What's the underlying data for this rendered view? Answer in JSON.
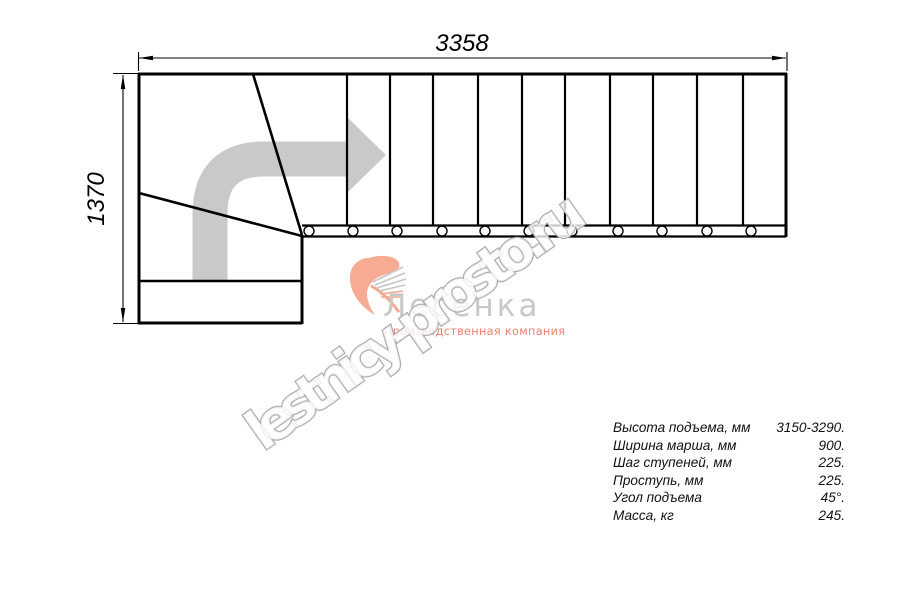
{
  "watermark": {
    "text": "lestnicy-prosto.ru"
  },
  "logo": {
    "title": "Лесенка",
    "tagline": "Производственная компания"
  },
  "dimensions": {
    "total_length_mm": "3358",
    "total_width_mm": "1370"
  },
  "specs": {
    "rows": [
      {
        "label": "Высота подъема, мм",
        "value": "3150-3290."
      },
      {
        "label": "Ширина марша, мм",
        "value": "900."
      },
      {
        "label": "Шаг ступеней, мм",
        "value": "225."
      },
      {
        "label": "Проступь, мм",
        "value": "225."
      },
      {
        "label": "Угол подъема",
        "value": "45°."
      },
      {
        "label": "Масса, кг",
        "value": "245."
      }
    ]
  },
  "colors": {
    "line": "#000000",
    "direction_arrow": "#c9c9c9",
    "logo_icon": "#f6ab92",
    "logo_text": "#c8c8c8",
    "logo_tagline": "#ed8170",
    "watermark_stroke": "#ababab"
  }
}
